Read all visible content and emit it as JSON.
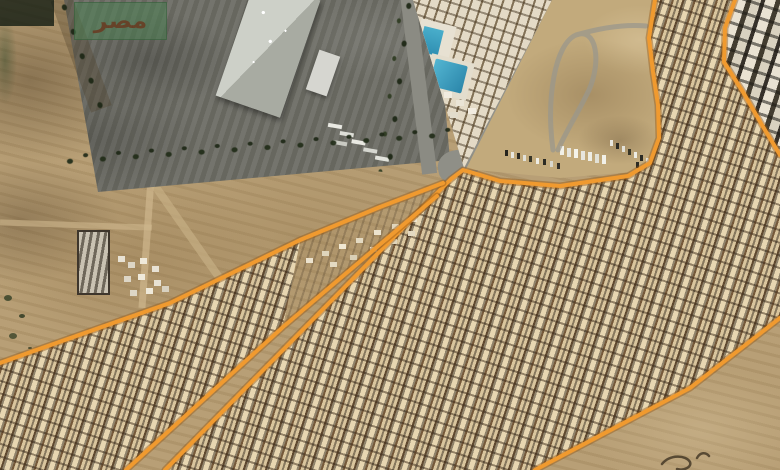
{
  "meta": {
    "kind": "satellite-map-with-boundary-annotation",
    "width": 780,
    "height": 470
  },
  "watermark": {
    "text": "مصر",
    "panel_color": "rgba(74,128,82,0.55)",
    "corner_color": "rgba(14,24,16,0.78)",
    "text_color": "rgba(104,58,32,0.85)"
  },
  "overlay": {
    "stroke_color": "#f09a2f",
    "casing_color": "rgba(150,88,20,0.45)",
    "polylines": {
      "main_boundary_west": [
        [
          655,
          0
        ],
        [
          649,
          38
        ],
        [
          653,
          72
        ],
        [
          658,
          105
        ],
        [
          659,
          138
        ],
        [
          650,
          163
        ],
        [
          628,
          176
        ],
        [
          560,
          186
        ],
        [
          500,
          181
        ],
        [
          470,
          172
        ],
        [
          463,
          170
        ],
        [
          451,
          179
        ],
        [
          447,
          183
        ],
        [
          165,
          470
        ]
      ],
      "main_boundary_southeast": [
        [
          535,
          470
        ],
        [
          690,
          388
        ],
        [
          780,
          318
        ]
      ],
      "main_boundary_east": [
        [
          735,
          0
        ],
        [
          725,
          28
        ],
        [
          724,
          62
        ],
        [
          743,
          92
        ],
        [
          762,
          125
        ],
        [
          780,
          155
        ]
      ],
      "wedge_boundary_north": [
        [
          443,
          183
        ],
        [
          380,
          207
        ],
        [
          300,
          240
        ],
        [
          170,
          303
        ],
        [
          28,
          353
        ],
        [
          0,
          363
        ]
      ],
      "wedge_boundary_southeast": [
        [
          437,
          196
        ],
        [
          283,
          327
        ],
        [
          126,
          470
        ]
      ]
    },
    "track_path": "M 553 150 C 546 98 555 44 576 35 C 596 27 602 60 589 90 C 578 113 565 133 558 150 M 576 35 C 600 28 625 24 646 26",
    "squiggle_path": "M 662 464 C 670 454 686 455 690 462 C 692 467 684 471 677 469 M 697 458 C 700 452 706 452 709 456"
  }
}
